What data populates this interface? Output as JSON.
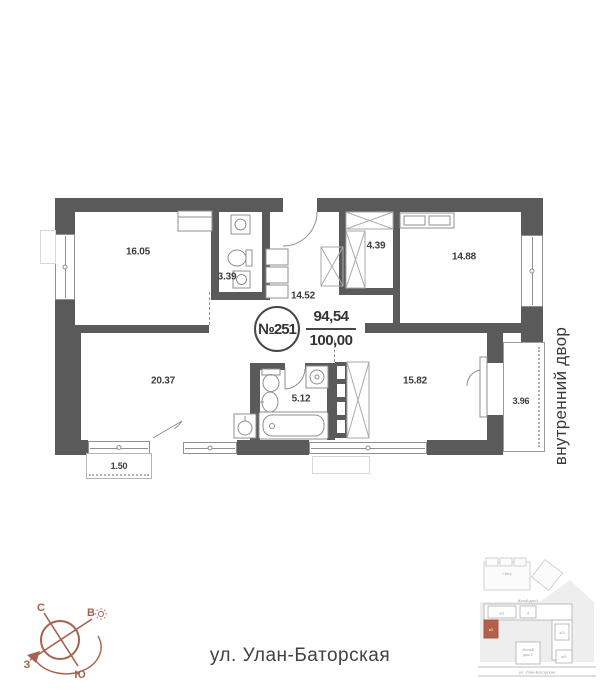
{
  "colors": {
    "wall": "#5a5a5a",
    "accent_red": "#b4604b",
    "compass": "#a5624e"
  },
  "plan": {
    "badge": {
      "number": "№251",
      "area_top": "94,54",
      "area_bottom": "100,00"
    },
    "rooms": {
      "living_room": "16.05",
      "bathroom_small": "3.39",
      "hallway": "14.52",
      "wardrobe": "4.39",
      "bedroom_right": "14.88",
      "kitchen_living": "20.37",
      "bathroom_big": "5.12",
      "bedroom_bottom": "15.82",
      "loggia": "3.96",
      "balcony": "1.50"
    }
  },
  "labels": {
    "courtyard": "внутренний двор",
    "street": "ул. Улан-Баторская"
  },
  "compass": {
    "north": "С",
    "east": "В",
    "south": "Ю",
    "west": "З"
  },
  "minimap": {
    "house_top": "Жилой дом 4",
    "house_bottom_line1": "Жилой",
    "house_bottom_line2": "дом 2",
    "block_1": "к/1",
    "block_2": "4",
    "block_red": "к/2",
    "block_3": "к/3",
    "block_4": "к/4",
    "park": "Сквер",
    "road": "ул. Улан-Баторская"
  }
}
